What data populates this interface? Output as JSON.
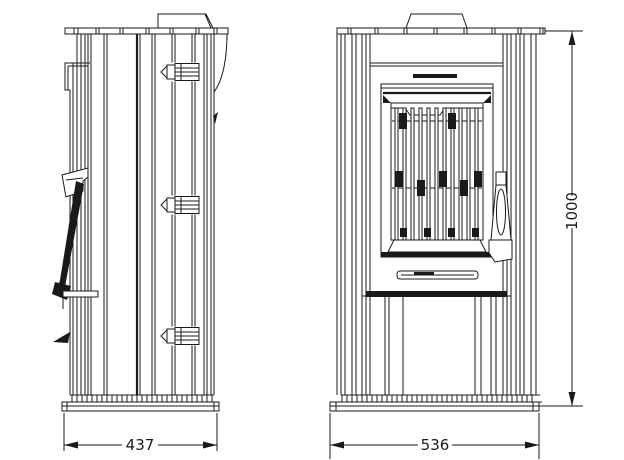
{
  "page": {
    "background_color": "#ffffff",
    "line_color": "#1a1a1a"
  },
  "drawing": {
    "subject": "wood-burning-stove-orthographic-technical-drawing",
    "side_view": {
      "id": "side-view",
      "width_dimension": "437",
      "parts": [
        "flue-collar",
        "top-plate",
        "ribbed-body",
        "door-hinge",
        "door-handle-lever",
        "base-plinth"
      ]
    },
    "front_view": {
      "id": "front-view",
      "width_dimension": "536",
      "height_dimension": "1000",
      "parts": [
        "flue-collar",
        "top-plate",
        "ribbed-body",
        "front-panel",
        "glass-door",
        "grille-bars",
        "door-handle",
        "ash-lip",
        "base-plinth"
      ]
    }
  }
}
